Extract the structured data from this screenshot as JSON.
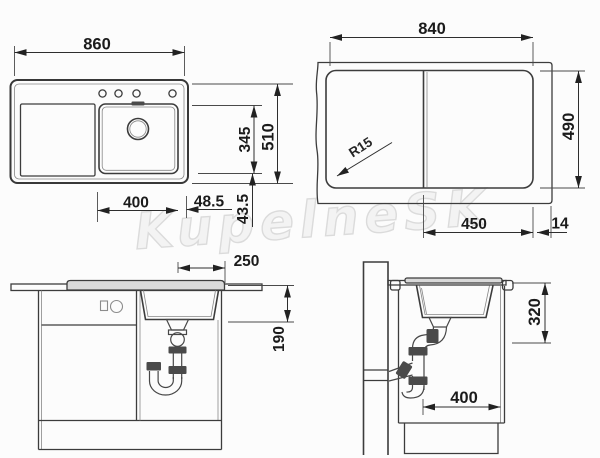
{
  "watermark": "KupelneSK",
  "drawing": {
    "top_view": {
      "overall_width": "860",
      "overall_depth": "510",
      "bowl_depth": "345",
      "bowl_width": "400",
      "edge_offset_right": "48.5",
      "edge_offset_bottom": "43.5"
    },
    "cutout_view": {
      "cutout_width": "840",
      "cutout_height": "490",
      "corner_radius": "R15",
      "divider_to_edge": "450",
      "edge_margin": "14"
    },
    "front_view": {
      "tap_to_edge": "250",
      "bowl_height": "190"
    },
    "side_view": {
      "clearance_height": "320",
      "cabinet_width": "400"
    }
  }
}
